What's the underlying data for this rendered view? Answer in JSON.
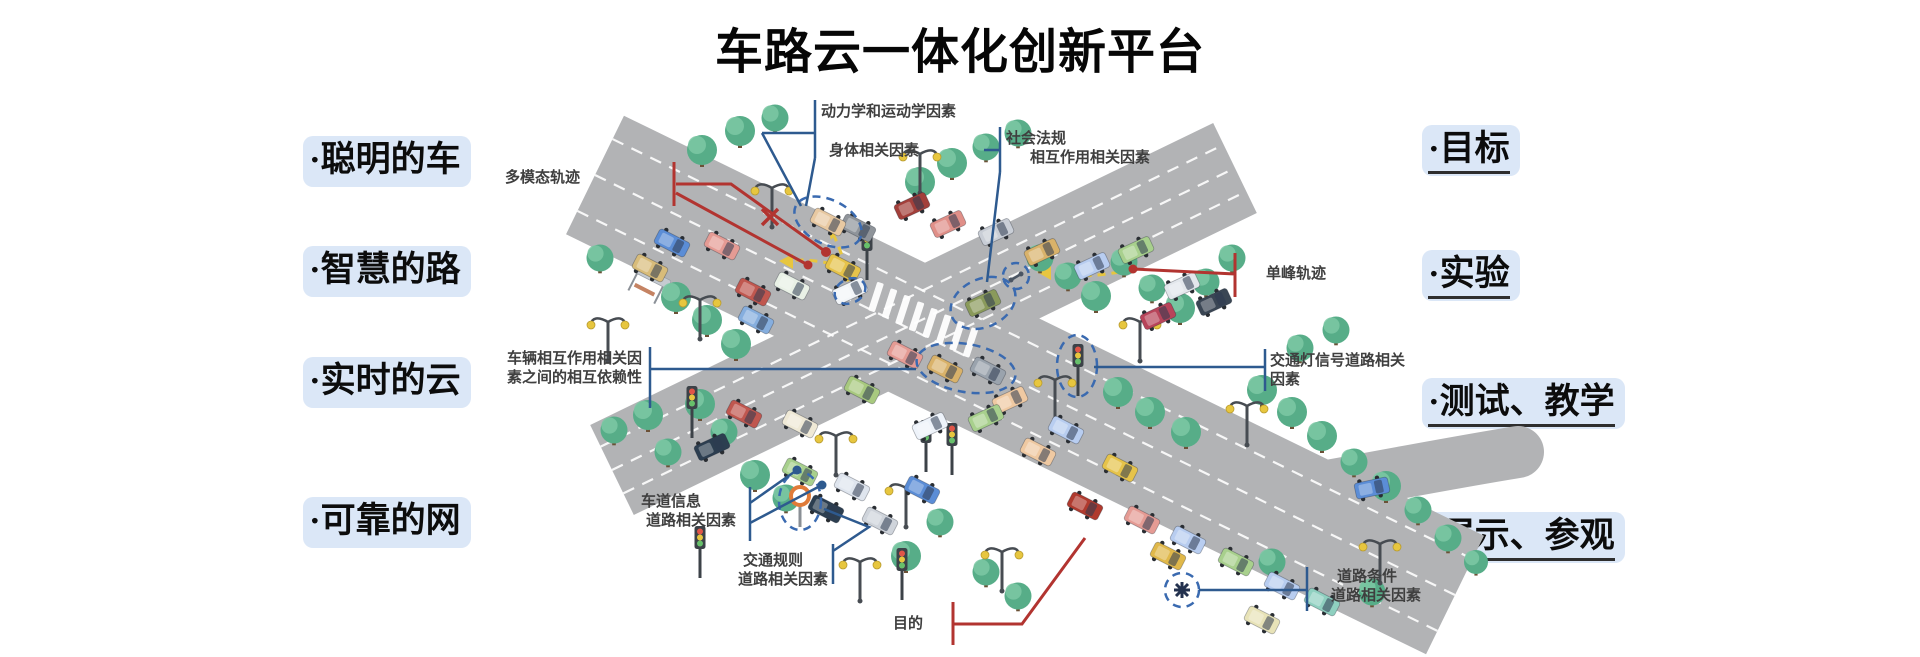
{
  "title": "车路云一体化创新平台",
  "left_labels": [
    {
      "text": "·聪明的车"
    },
    {
      "text": "·智慧的路"
    },
    {
      "text": "·实时的云"
    },
    {
      "text": "·可靠的网"
    }
  ],
  "right_labels": [
    {
      "text": "·目标"
    },
    {
      "text": "·实验"
    },
    {
      "text": "·测试、教学"
    },
    {
      "text": "·展示、参观"
    }
  ],
  "callouts": {
    "dynamics": "动力学和运动学因素",
    "body": "身体相关因素",
    "social_1": "社会法规",
    "social_2": "相互作用相关因素",
    "multimodal": "多模态轨迹",
    "interaction_1": "车辆相互作用相关因",
    "interaction_2": "素之间的相互依赖性",
    "lane_1": "车道信息",
    "lane_2": "道路相关因素",
    "rules_1": "交通规则",
    "rules_2": "道路相关因素",
    "purpose": "目的",
    "unimodal": "单峰轨迹",
    "signal_1": "交通灯信号道路相关",
    "signal_2": "因素",
    "road_1": "道路条件",
    "road_2": "道路相关因素"
  },
  "colors": {
    "pill_bg": "#dbe7f7",
    "callout_blue": "#2e5a8f",
    "callout_red": "#b23430",
    "trajectory_yellow": "#e7c63f",
    "highlight_dash_blue": "#3a6ab0",
    "road_grey": "#b2b3b5",
    "tree_green": "#57ad88",
    "sign_orange": "#e07b39"
  },
  "decor": {
    "roads": {
      "color": "#b2b3b5",
      "main": {
        "line": [
          595,
          175,
          1455,
          595
        ],
        "width": 132,
        "lane_offsets": [
          -40,
          0,
          40
        ]
      },
      "cross": {
        "line": [
          612,
          470,
          1235,
          168
        ],
        "width": 100,
        "lane_offsets": [
          -26,
          0,
          26
        ]
      },
      "spur": {
        "path": "M1190,507 C1300,494 1390,473 1518,452",
        "width": 52
      }
    },
    "crosswalk": {
      "x": 876,
      "y": 297,
      "dx": 13.5,
      "dy": 6.5,
      "count": 8,
      "w": 7,
      "h": 30,
      "rot": 18
    },
    "trees": [
      [
        702,
        150,
        1
      ],
      [
        740,
        131,
        1
      ],
      [
        775,
        118,
        0.9
      ],
      [
        920,
        182,
        1
      ],
      [
        952,
        163,
        1
      ],
      [
        986,
        147,
        0.9
      ],
      [
        1018,
        133,
        0.9
      ],
      [
        600,
        258,
        0.9
      ],
      [
        676,
        297,
        1
      ],
      [
        707,
        320,
        1
      ],
      [
        736,
        344,
        1
      ],
      [
        614,
        430,
        0.9
      ],
      [
        648,
        415,
        1
      ],
      [
        700,
        404,
        1
      ],
      [
        668,
        452,
        0.9
      ],
      [
        724,
        432,
        0.9
      ],
      [
        755,
        475,
        1
      ],
      [
        786,
        498,
        0.9
      ],
      [
        1040,
        258,
        0.9
      ],
      [
        1068,
        276,
        0.9
      ],
      [
        1096,
        296,
        1
      ],
      [
        1124,
        262,
        0.9
      ],
      [
        1152,
        288,
        0.9
      ],
      [
        1180,
        308,
        1
      ],
      [
        1206,
        282,
        0.9
      ],
      [
        1232,
        258,
        0.9
      ],
      [
        1262,
        390,
        1
      ],
      [
        1292,
        412,
        1
      ],
      [
        1322,
        436,
        1
      ],
      [
        1354,
        462,
        0.9
      ],
      [
        1386,
        486,
        1
      ],
      [
        1418,
        510,
        0.9
      ],
      [
        1300,
        348,
        0.9
      ],
      [
        1336,
        330,
        0.9
      ],
      [
        1118,
        392,
        1
      ],
      [
        1150,
        412,
        1
      ],
      [
        1186,
        432,
        1
      ],
      [
        940,
        522,
        0.9
      ],
      [
        906,
        556,
        1
      ],
      [
        986,
        572,
        0.9
      ],
      [
        1018,
        596,
        0.9
      ],
      [
        1272,
        562,
        0.9
      ],
      [
        1372,
        592,
        0.9
      ],
      [
        1448,
        538,
        0.9
      ],
      [
        1476,
        562,
        0.8
      ]
    ],
    "lamps": [
      [
        772,
        218
      ],
      [
        700,
        330
      ],
      [
        836,
        466
      ],
      [
        906,
        518
      ],
      [
        1055,
        410
      ],
      [
        1140,
        352
      ],
      [
        1247,
        436
      ],
      [
        1002,
        582
      ],
      [
        1380,
        574
      ],
      [
        860,
        592
      ],
      [
        920,
        184
      ],
      [
        608,
        352
      ]
    ],
    "traffic_lights": [
      [
        867,
        280
      ],
      [
        1078,
        396
      ],
      [
        692,
        438
      ],
      [
        926,
        472
      ],
      [
        952,
        475
      ],
      [
        700,
        578
      ],
      [
        902,
        600
      ]
    ],
    "vehicles": [
      [
        672,
        243,
        27,
        "#5b8dd6"
      ],
      [
        722,
        246,
        27,
        "#e59b94"
      ],
      [
        858,
        228,
        27,
        "#8f949a"
      ],
      [
        828,
        222,
        27,
        "#e8c9a2"
      ],
      [
        650,
        268,
        27,
        "#d8bc7a"
      ],
      [
        753,
        292,
        27,
        "#c0574f"
      ],
      [
        792,
        286,
        27,
        "#e9f1e6"
      ],
      [
        843,
        268,
        27,
        "#e6c34a"
      ],
      [
        756,
        320,
        27,
        "#86aede"
      ],
      [
        912,
        206,
        -25,
        "#a33f3a"
      ],
      [
        948,
        224,
        -25,
        "#e08f88"
      ],
      [
        996,
        232,
        -25,
        "#c9ced6"
      ],
      [
        1042,
        252,
        -25,
        "#d9b26a"
      ],
      [
        1092,
        266,
        -25,
        "#b8cdf0"
      ],
      [
        1136,
        250,
        -25,
        "#a8d08d"
      ],
      [
        1182,
        286,
        -25,
        "#e3e7ec"
      ],
      [
        1214,
        302,
        -25,
        "#3a4654"
      ],
      [
        1158,
        316,
        -25,
        "#b8445a"
      ],
      [
        850,
        291,
        -25,
        "#f2f5f8"
      ],
      [
        983,
        303,
        -25,
        "#8a9a5b"
      ],
      [
        905,
        355,
        27,
        "#e59b94"
      ],
      [
        945,
        369,
        27,
        "#d9b26a"
      ],
      [
        988,
        371,
        27,
        "#9aa3ad"
      ],
      [
        862,
        390,
        27,
        "#a8c97f"
      ],
      [
        800,
        424,
        27,
        "#efe9d6"
      ],
      [
        744,
        414,
        27,
        "#c0574f"
      ],
      [
        930,
        426,
        -25,
        "#eef3fa"
      ],
      [
        712,
        447,
        -25,
        "#2c3e50"
      ],
      [
        800,
        472,
        27,
        "#a8d08d"
      ],
      [
        852,
        487,
        27,
        "#dfe5ee"
      ],
      [
        826,
        509,
        27,
        "#2c3e50"
      ],
      [
        922,
        490,
        27,
        "#5b8dd6"
      ],
      [
        880,
        521,
        27,
        "#cfd4db"
      ],
      [
        1010,
        400,
        -25,
        "#efc9a2"
      ],
      [
        986,
        418,
        -25,
        "#a8d08d"
      ],
      [
        1038,
        452,
        27,
        "#efc9a2"
      ],
      [
        1066,
        430,
        27,
        "#b8cdf0"
      ],
      [
        1120,
        468,
        27,
        "#e6c34a"
      ],
      [
        1085,
        506,
        27,
        "#b03a2e"
      ],
      [
        1142,
        520,
        27,
        "#e59b94"
      ],
      [
        1188,
        540,
        27,
        "#b8cdf0"
      ],
      [
        1236,
        562,
        27,
        "#a8d08d"
      ],
      [
        1282,
        586,
        27,
        "#b8cdf0"
      ],
      [
        1322,
        602,
        27,
        "#8fd0c0"
      ],
      [
        1262,
        620,
        27,
        "#e8e3b8"
      ],
      [
        1168,
        556,
        27,
        "#e0b84a"
      ],
      [
        1372,
        488,
        -12,
        "#5b8dd6"
      ]
    ],
    "highlights": [
      [
        828,
        222,
        36,
        22,
        27
      ],
      [
        850,
        291,
        16,
        12,
        -25
      ],
      [
        983,
        303,
        34,
        24,
        -25
      ],
      [
        1016,
        276,
        13,
        13,
        0
      ],
      [
        966,
        368,
        50,
        24,
        10
      ],
      [
        1077,
        366,
        20,
        31,
        0
      ],
      [
        800,
        501,
        21,
        29,
        0
      ],
      [
        1182,
        590,
        17,
        17,
        0
      ]
    ]
  }
}
